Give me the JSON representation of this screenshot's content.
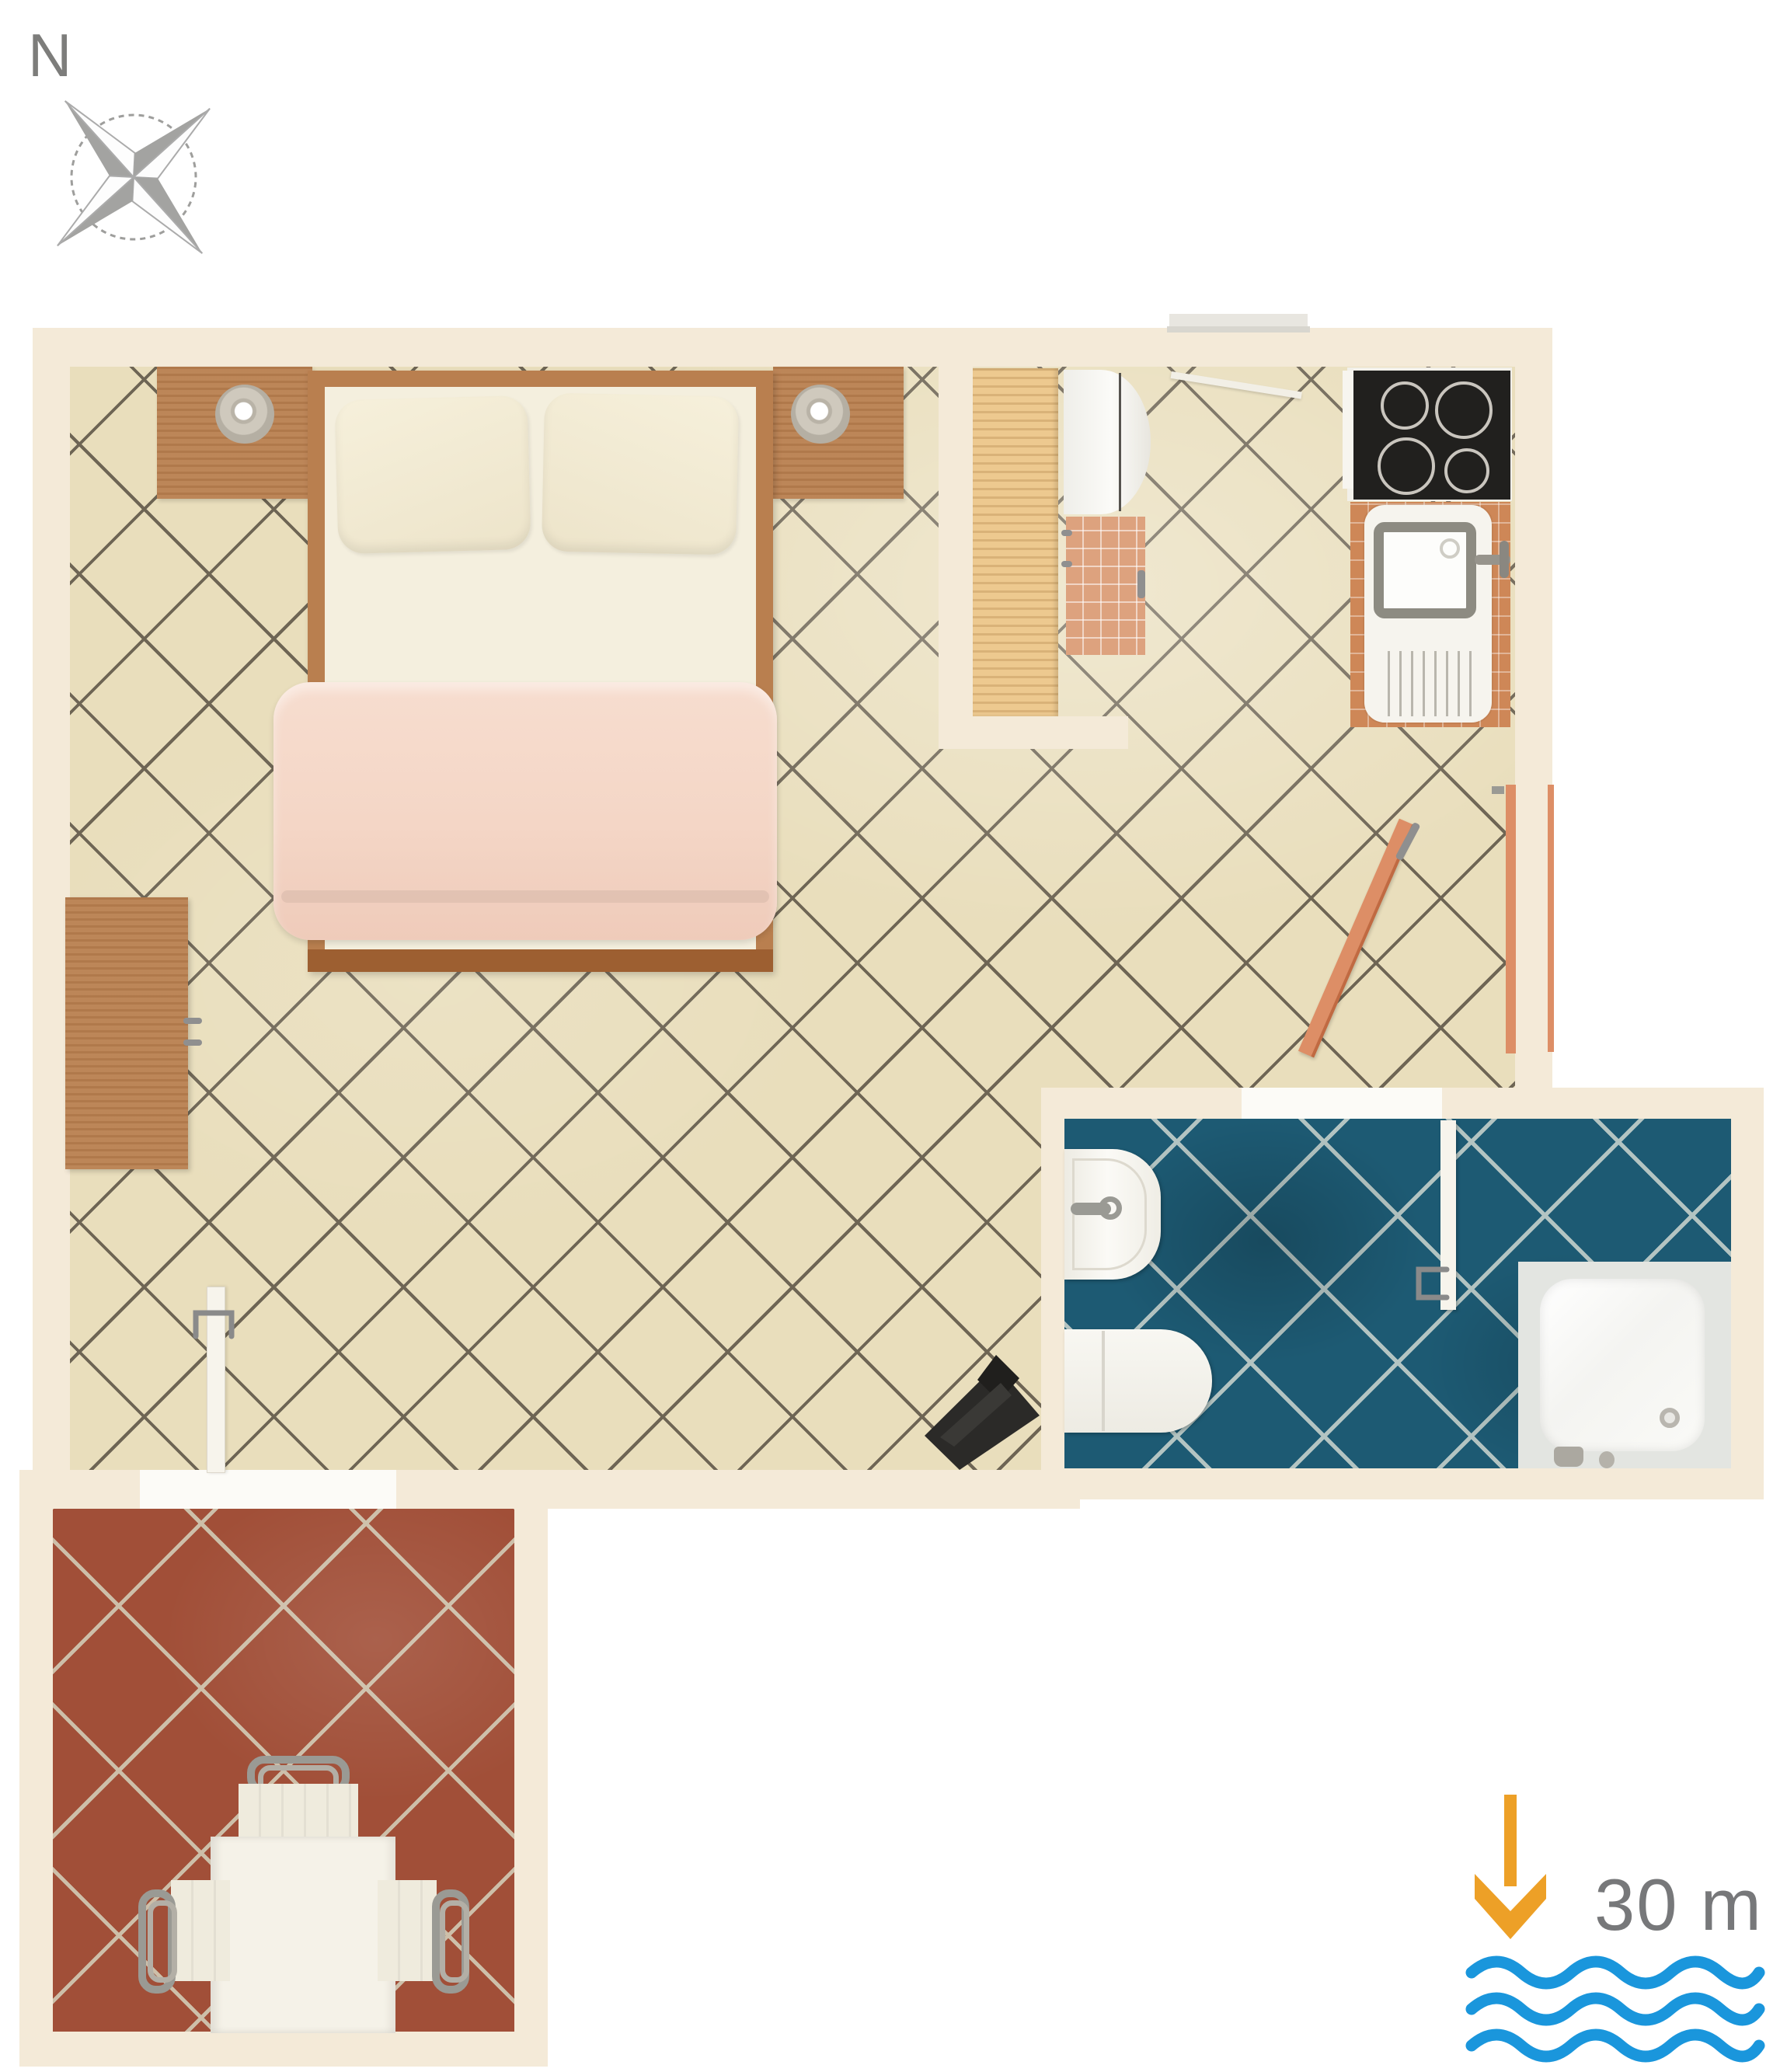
{
  "compass": {
    "label": "N",
    "icon": "compass-rose-icon"
  },
  "legend": {
    "distance_text": "30 m",
    "arrow_icon": "down-arrow-icon",
    "sea_icon": "sea-waves-icon"
  },
  "colors": {
    "wall": "#F4EAD8",
    "floor": "#E9DEBC",
    "floor_grout": "#6E6554",
    "bath": "#1D5A73",
    "bath_grout": "#B3C4C2",
    "terrace": "#A14F38",
    "terrace_grout": "#CDBFA9",
    "wood": "#B97F4F",
    "wood_dark": "#9D5F31",
    "pine": "#EDC98F",
    "mattress": "#F4EFDE",
    "pillow": "#F1E9D2",
    "blanket": "#F4D7C8",
    "white_fixture": "#F6F4EE",
    "steel": "#9A9A94",
    "stove": "#21201E",
    "counter_tile": "#CE8757",
    "cabinet_tile": "#DDA27E",
    "door_orange": "#DD8E66",
    "arrow_orange": "#EDA027",
    "wave_blue": "#1A96DC",
    "label_gray": "#77787A",
    "compass_gray": "#9E9E9C"
  }
}
